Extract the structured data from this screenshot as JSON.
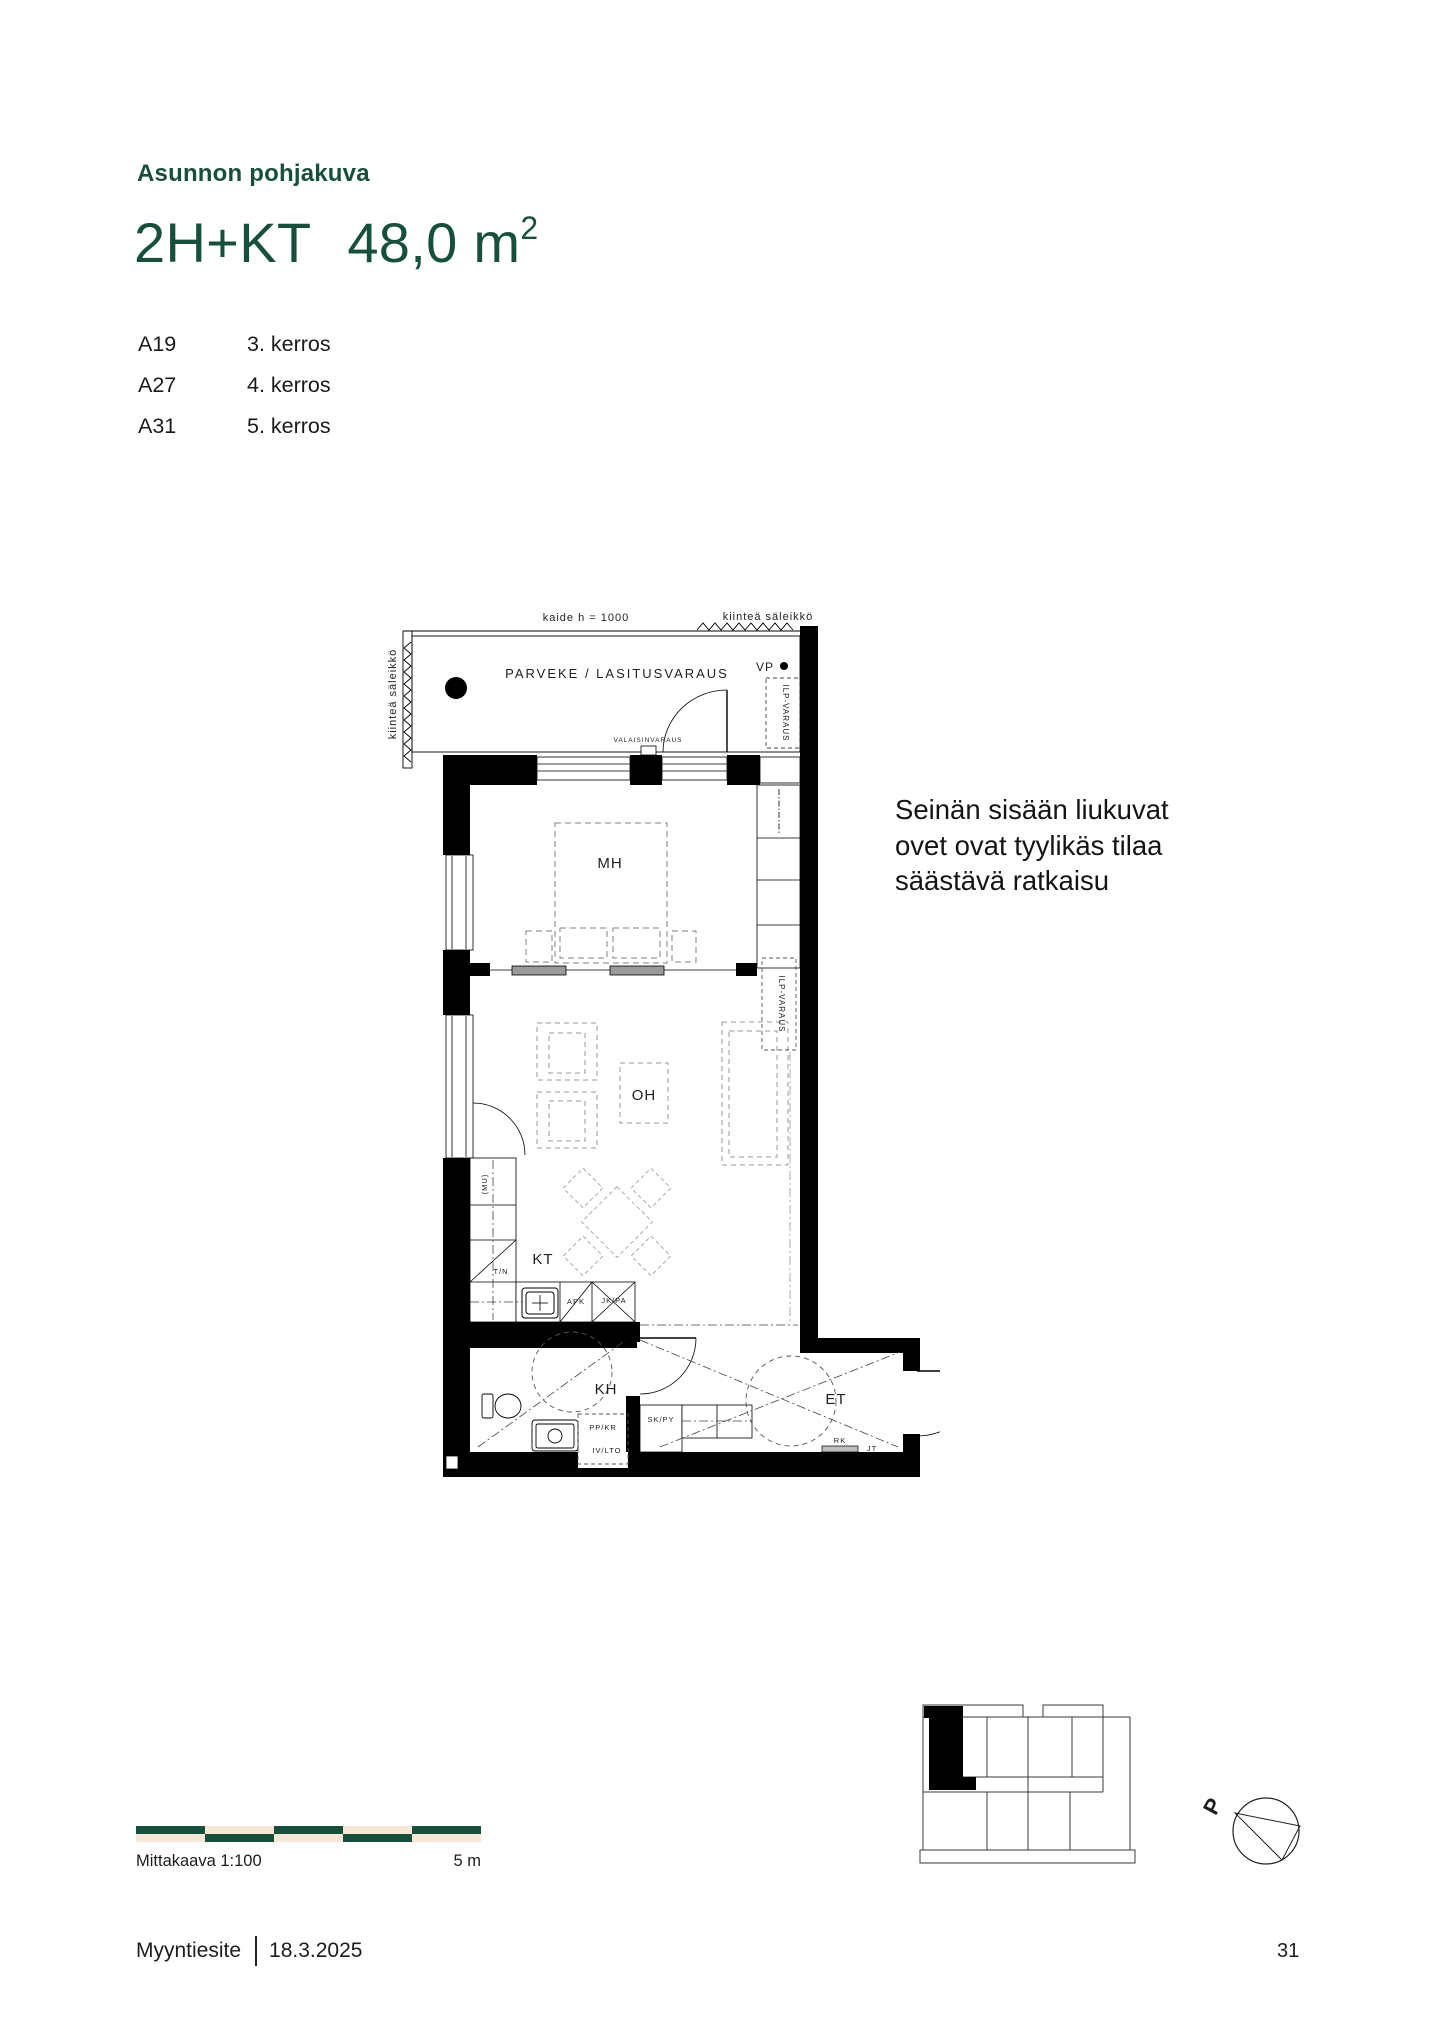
{
  "colors": {
    "accent_green": "#16503a",
    "scale_light": "#f6e7d6",
    "ink": "#1a1a1a"
  },
  "header": {
    "eyebrow": "Asunnon pohjakuva",
    "type_label": "2H+KT",
    "area_label": "48,0 m",
    "area_sup": "2"
  },
  "apartments": [
    {
      "unit": "A19",
      "floor": "3. kerros"
    },
    {
      "unit": "A27",
      "floor": "4. kerros"
    },
    {
      "unit": "A31",
      "floor": "5. kerros"
    }
  ],
  "note": {
    "line1": "Seinän sisään liukuvat",
    "line2": "ovet ovat tyylikäs tilaa",
    "line3": "säästävä ratkaisu"
  },
  "floorplan": {
    "balcony": {
      "label": "PARVEKE / LASITUSVARAUS",
      "railing": "kaide h = 1000",
      "grille_top": "kiinteä säleikkö",
      "grille_left": "kiinteä säleikkö",
      "vp": "VP",
      "ilp": "ILP-VARAUS",
      "light": "VALAISINVARAUS"
    },
    "rooms": {
      "bedroom": "MH",
      "living": "OH",
      "kitchen": "KT",
      "bathroom": "KH",
      "entry": "ET"
    },
    "annotations": {
      "ilp2": "ILP-VARAUS",
      "mu": "(MU)",
      "tn": "T/N",
      "apk": "APK",
      "jkpa": "JK/PA",
      "ppkr": "PP/KR",
      "ivlto": "IV/LTO",
      "skpy": "SK/PY",
      "rk": "RK",
      "jt": "JT"
    }
  },
  "scalebar": {
    "label": "Mittakaava 1:100",
    "max_label": "5 m",
    "dark": "#16503a",
    "light": "#f6e7d6"
  },
  "keyplan": {
    "north": "P"
  },
  "footer": {
    "doc": "Myyntiesite",
    "date": "18.3.2025",
    "page": "31"
  }
}
